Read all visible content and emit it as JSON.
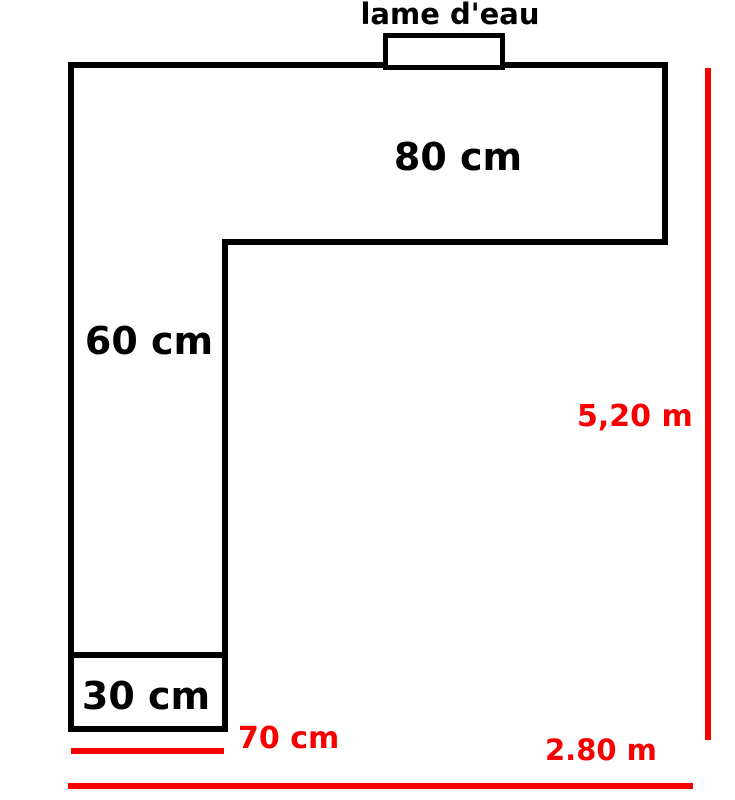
{
  "diagram": {
    "labels": {
      "water_blade": "lame d'eau",
      "depth_top_section": "80 cm",
      "depth_left_column": "60 cm",
      "depth_bottom_box": "30 cm",
      "width_bottom": "70 cm",
      "length_total_height": "5,20 m",
      "length_total_width": "2.80 m"
    },
    "colors": {
      "outline": "#000000",
      "dimension": "#f80000",
      "background": "#ffffff"
    }
  }
}
